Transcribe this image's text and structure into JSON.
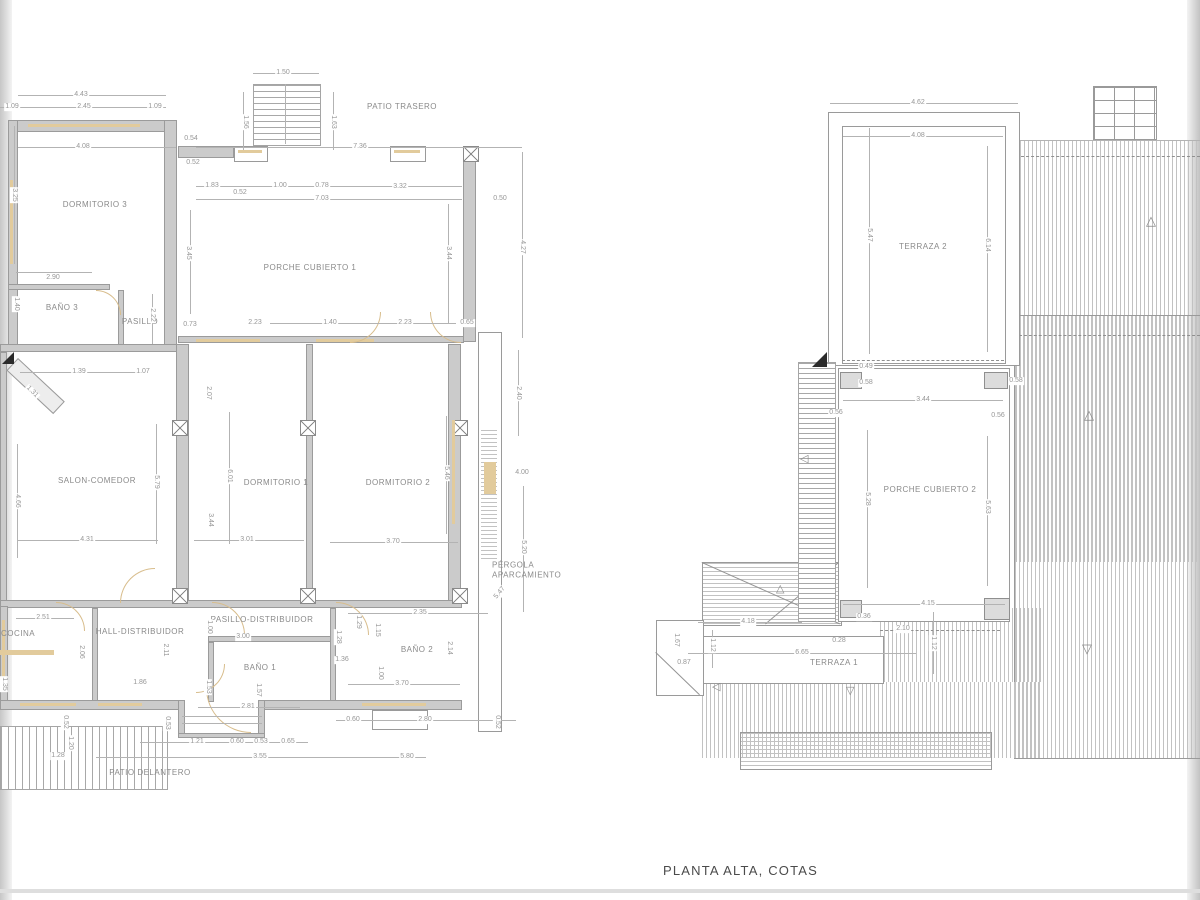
{
  "title": "PLANTA ALTA, COTAS",
  "left_plan": {
    "rooms": [
      {
        "label": "PATIO TRASERO",
        "x": 402,
        "y": 107
      },
      {
        "label": "DORMITORIO 3",
        "x": 95,
        "y": 205
      },
      {
        "label": "BAÑO 3",
        "x": 62,
        "y": 308
      },
      {
        "label": "PASILLO",
        "x": 140,
        "y": 322
      },
      {
        "label": "PORCHE CUBIERTO 1",
        "x": 310,
        "y": 268
      },
      {
        "label": "SALON-COMEDOR",
        "x": 97,
        "y": 481
      },
      {
        "label": "DORMITORIO 1",
        "x": 276,
        "y": 483
      },
      {
        "label": "DORMITORIO 2",
        "x": 398,
        "y": 483
      },
      {
        "label": "PÉRGOLA APARCAMIENTO",
        "x": 528,
        "y": 571,
        "w": 72
      },
      {
        "label": "COCINA",
        "x": 18,
        "y": 634
      },
      {
        "label": "HALL-DISTRIBUIDOR",
        "x": 140,
        "y": 632
      },
      {
        "label": "PASILLO-DISTRIBUIDOR",
        "x": 262,
        "y": 620
      },
      {
        "label": "BAÑO 1",
        "x": 260,
        "y": 668
      },
      {
        "label": "BAÑO 2",
        "x": 417,
        "y": 650
      },
      {
        "label": "PATIO DELANTERO",
        "x": 150,
        "y": 773
      }
    ],
    "dims": [
      {
        "v": "1.50",
        "x": 283,
        "y": 73
      },
      {
        "v": "4.43",
        "x": 81,
        "y": 95
      },
      {
        "v": "1.09",
        "x": 12,
        "y": 107
      },
      {
        "v": "2.45",
        "x": 84,
        "y": 107
      },
      {
        "v": "1.09",
        "x": 155,
        "y": 107
      },
      {
        "v": "1.56",
        "x": 245,
        "y": 122,
        "r": 90
      },
      {
        "v": "1.63",
        "x": 333,
        "y": 122,
        "r": 90
      },
      {
        "v": "4.08",
        "x": 83,
        "y": 147
      },
      {
        "v": "0.54",
        "x": 191,
        "y": 139
      },
      {
        "v": "7.36",
        "x": 360,
        "y": 147
      },
      {
        "v": "0.52",
        "x": 193,
        "y": 163
      },
      {
        "v": "1.83",
        "x": 212,
        "y": 186
      },
      {
        "v": "0.52",
        "x": 240,
        "y": 193
      },
      {
        "v": "1.00",
        "x": 280,
        "y": 186
      },
      {
        "v": "0.78",
        "x": 322,
        "y": 186
      },
      {
        "v": "3.32",
        "x": 400,
        "y": 187
      },
      {
        "v": "7.03",
        "x": 322,
        "y": 199
      },
      {
        "v": "0.50",
        "x": 500,
        "y": 199
      },
      {
        "v": "3.25",
        "x": 14,
        "y": 195,
        "r": 90
      },
      {
        "v": "2.90",
        "x": 53,
        "y": 278
      },
      {
        "v": "1.40",
        "x": 16,
        "y": 304,
        "r": 90
      },
      {
        "v": "2.22",
        "x": 152,
        "y": 315,
        "r": 90
      },
      {
        "v": "0.73",
        "x": 190,
        "y": 325
      },
      {
        "v": "2.23",
        "x": 255,
        "y": 323
      },
      {
        "v": "1.40",
        "x": 330,
        "y": 323
      },
      {
        "v": "2.23",
        "x": 405,
        "y": 323
      },
      {
        "v": "0.65",
        "x": 467,
        "y": 323
      },
      {
        "v": "3.45",
        "x": 188,
        "y": 253,
        "r": 90
      },
      {
        "v": "3.44",
        "x": 448,
        "y": 253,
        "r": 90
      },
      {
        "v": "4.27",
        "x": 522,
        "y": 247,
        "r": 90
      },
      {
        "v": "2.40",
        "x": 518,
        "y": 393,
        "r": 90
      },
      {
        "v": "1.39",
        "x": 79,
        "y": 372
      },
      {
        "v": "1.07",
        "x": 143,
        "y": 372
      },
      {
        "v": "1.31",
        "x": 32,
        "y": 392,
        "r": 45
      },
      {
        "v": "2.07",
        "x": 208,
        "y": 393,
        "r": 90
      },
      {
        "v": "6.01",
        "x": 229,
        "y": 476,
        "r": 90
      },
      {
        "v": "5.79",
        "x": 156,
        "y": 482,
        "r": 90
      },
      {
        "v": "4.66",
        "x": 17,
        "y": 501,
        "r": 90
      },
      {
        "v": "3.44",
        "x": 210,
        "y": 520,
        "r": 90
      },
      {
        "v": "4.31",
        "x": 87,
        "y": 540
      },
      {
        "v": "3.01",
        "x": 247,
        "y": 540
      },
      {
        "v": "3.70",
        "x": 393,
        "y": 542
      },
      {
        "v": "5.46",
        "x": 446,
        "y": 473,
        "r": 90
      },
      {
        "v": "4.00",
        "x": 522,
        "y": 473
      },
      {
        "v": "5.20",
        "x": 523,
        "y": 547,
        "r": 90
      },
      {
        "v": "5.47",
        "x": 500,
        "y": 593,
        "r": -50
      },
      {
        "v": "2.35",
        "x": 420,
        "y": 613
      },
      {
        "v": "1.29",
        "x": 358,
        "y": 622,
        "r": 90
      },
      {
        "v": "1.15",
        "x": 377,
        "y": 630,
        "r": 90
      },
      {
        "v": "2.51",
        "x": 43,
        "y": 618
      },
      {
        "v": "1.00",
        "x": 209,
        "y": 627,
        "r": 90
      },
      {
        "v": "3.00",
        "x": 243,
        "y": 637
      },
      {
        "v": "2.06",
        "x": 81,
        "y": 652,
        "r": 90
      },
      {
        "v": "2.11",
        "x": 165,
        "y": 650,
        "r": 90
      },
      {
        "v": "1.35",
        "x": 4,
        "y": 684,
        "r": 90
      },
      {
        "v": "1.86",
        "x": 140,
        "y": 683
      },
      {
        "v": "1.53",
        "x": 208,
        "y": 687,
        "r": 90
      },
      {
        "v": "1.57",
        "x": 258,
        "y": 690,
        "r": 90
      },
      {
        "v": "2.81",
        "x": 248,
        "y": 707
      },
      {
        "v": "0.52",
        "x": 65,
        "y": 722,
        "r": 90
      },
      {
        "v": "0.53",
        "x": 167,
        "y": 723,
        "r": 90
      },
      {
        "v": "1.20",
        "x": 70,
        "y": 743,
        "r": 90
      },
      {
        "v": "1.28",
        "x": 58,
        "y": 756
      },
      {
        "v": "1.21",
        "x": 197,
        "y": 742
      },
      {
        "v": "0.60",
        "x": 237,
        "y": 742
      },
      {
        "v": "0.53",
        "x": 261,
        "y": 742
      },
      {
        "v": "0.65",
        "x": 288,
        "y": 742
      },
      {
        "v": "3.55",
        "x": 260,
        "y": 757
      },
      {
        "v": "0.60",
        "x": 353,
        "y": 720
      },
      {
        "v": "2.80",
        "x": 425,
        "y": 720
      },
      {
        "v": "0.52",
        "x": 497,
        "y": 722,
        "r": 90
      },
      {
        "v": "5.80",
        "x": 407,
        "y": 757
      },
      {
        "v": "1.28",
        "x": 338,
        "y": 637,
        "r": 90
      },
      {
        "v": "1.36",
        "x": 342,
        "y": 660
      },
      {
        "v": "1.00",
        "x": 380,
        "y": 673,
        "r": 90
      },
      {
        "v": "3.70",
        "x": 402,
        "y": 684
      },
      {
        "v": "2.14",
        "x": 449,
        "y": 648,
        "r": 90
      }
    ]
  },
  "right_plan": {
    "rooms": [
      {
        "label": "TERRAZA 2",
        "x": 923,
        "y": 247
      },
      {
        "label": "PORCHE CUBIERTO 2",
        "x": 930,
        "y": 490
      },
      {
        "label": "TERRAZA 1",
        "x": 834,
        "y": 663
      }
    ],
    "dims": [
      {
        "v": "4.62",
        "x": 918,
        "y": 103
      },
      {
        "v": "4.08",
        "x": 918,
        "y": 136
      },
      {
        "v": "5.47",
        "x": 869,
        "y": 235,
        "r": 90
      },
      {
        "v": "6.14",
        "x": 987,
        "y": 245,
        "r": 90
      },
      {
        "v": "0.49",
        "x": 866,
        "y": 367
      },
      {
        "v": "0.58",
        "x": 866,
        "y": 383
      },
      {
        "v": "0.58",
        "x": 1016,
        "y": 381
      },
      {
        "v": "3.44",
        "x": 923,
        "y": 400
      },
      {
        "v": "0.56",
        "x": 836,
        "y": 413
      },
      {
        "v": "0.56",
        "x": 998,
        "y": 416
      },
      {
        "v": "5.28",
        "x": 867,
        "y": 499,
        "r": 90
      },
      {
        "v": "5.63",
        "x": 987,
        "y": 507,
        "r": 90
      },
      {
        "v": "4.15",
        "x": 928,
        "y": 604
      },
      {
        "v": "0.36",
        "x": 864,
        "y": 617
      },
      {
        "v": "2.10",
        "x": 903,
        "y": 629
      },
      {
        "v": "0.28",
        "x": 839,
        "y": 641
      },
      {
        "v": "1.12",
        "x": 933,
        "y": 643,
        "r": 90
      },
      {
        "v": "4.18",
        "x": 748,
        "y": 622
      },
      {
        "v": "1.12",
        "x": 712,
        "y": 645,
        "r": 90
      },
      {
        "v": "6.65",
        "x": 802,
        "y": 653
      },
      {
        "v": "0.87",
        "x": 684,
        "y": 663
      },
      {
        "v": "1.67",
        "x": 676,
        "y": 640,
        "r": 90
      }
    ]
  }
}
